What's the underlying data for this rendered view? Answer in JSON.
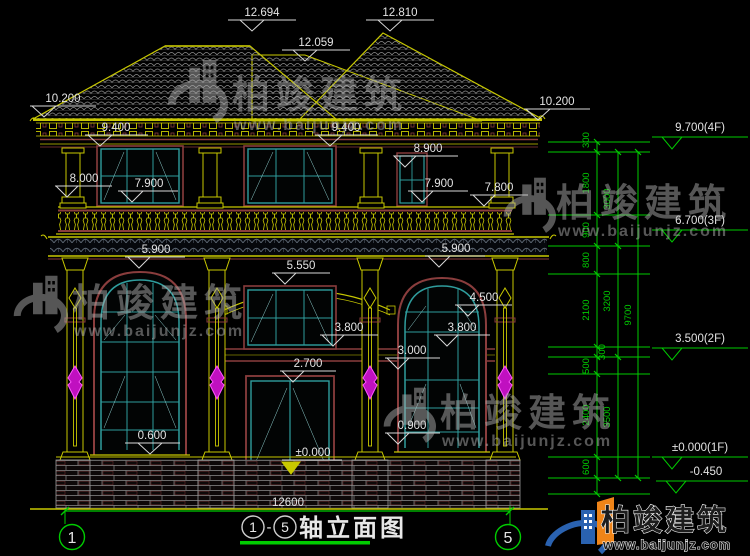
{
  "title": {
    "axis_from": "1",
    "dash": "-",
    "axis_to": "5",
    "text": "轴立面图"
  },
  "axes": {
    "left": "1",
    "right": "5"
  },
  "bottom_dim": "12600",
  "marks": {
    "peak_left": "12.694",
    "peak_right": "12.810",
    "ridge_mid": "12.059",
    "eave_left": "10.200",
    "eave_right": "10.200",
    "band_left": "9.400",
    "band_mid": "9.400",
    "win_attic": "8.900",
    "capital_left": "8.000",
    "rail_left": "7.900",
    "rail_mid": "7.900",
    "rail_right": "7.800",
    "canopy_left": "5.900",
    "canopy_right": "5.900",
    "arch_center": "5.550",
    "arch_right": "4.500",
    "head_center": "3.800",
    "head_right": "3.800",
    "band_right": "3.000",
    "door_head": "2.700",
    "sill_right": "0.900",
    "sill_left": "0.600",
    "ground_center": "±0.000"
  },
  "right_chain": {
    "segments_inner": [
      "300",
      "1800",
      "900",
      "800",
      "2100",
      "300",
      "500",
      "2400",
      "600"
    ],
    "segments_mid": [
      "3000",
      "3200",
      "3500"
    ],
    "total": "9700",
    "level_flags": [
      "9.700(4F)",
      "6.700(3F)",
      "3.500(2F)",
      "±0.000(1F)",
      "-0.450"
    ]
  },
  "watermark": {
    "name": "柏竣建筑",
    "url": "www.baijunjz.com"
  },
  "brand": {
    "name": "柏竣建筑",
    "url": "www.baijunjz.com"
  },
  "colors": {
    "line_yellow": "#c8c800",
    "line_green": "#00cc00",
    "teal": "#2f9d9d",
    "maroon": "#8a3d3d",
    "magenta": "#e020e0",
    "brand_blue": "#2a62b0",
    "brand_orange": "#ef8418"
  }
}
